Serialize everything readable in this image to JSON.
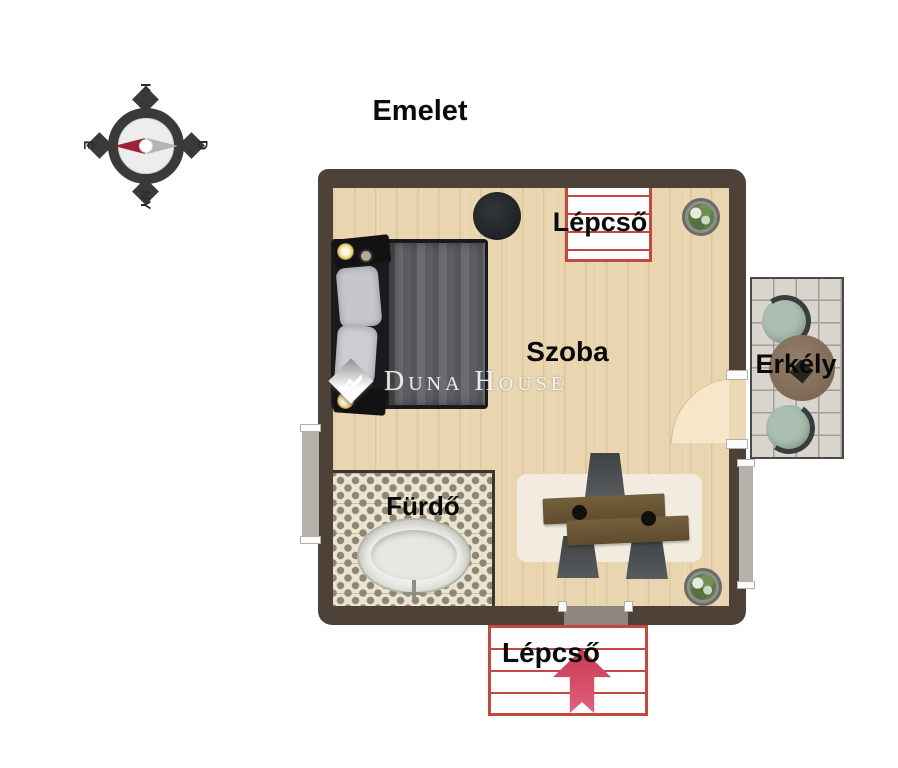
{
  "title": "Emelet",
  "compass": {
    "top": "K",
    "right": "D",
    "bottom": "NY",
    "left": "É"
  },
  "labels": {
    "room": "Szoba",
    "bathroom": "Fürdő",
    "balcony": "Erkély",
    "stairs_upper": "Lépcső",
    "stairs_lower": "Lépcső"
  },
  "watermark": {
    "text": "Duna House"
  },
  "colors": {
    "wall": "#4d4138",
    "floor_wood": "#e9d6b0",
    "stairs_outline": "#c24840",
    "direction_arrow": "#d6495f",
    "bath_tile_gray": "#8d8776",
    "bath_tile_cream": "#ece4cf",
    "balcony_tile": "#d9d4cd",
    "compass_needle_north": "#9e2236",
    "compass_needle_south": "#b4b4b4",
    "label_text": "#0a0a0a"
  }
}
